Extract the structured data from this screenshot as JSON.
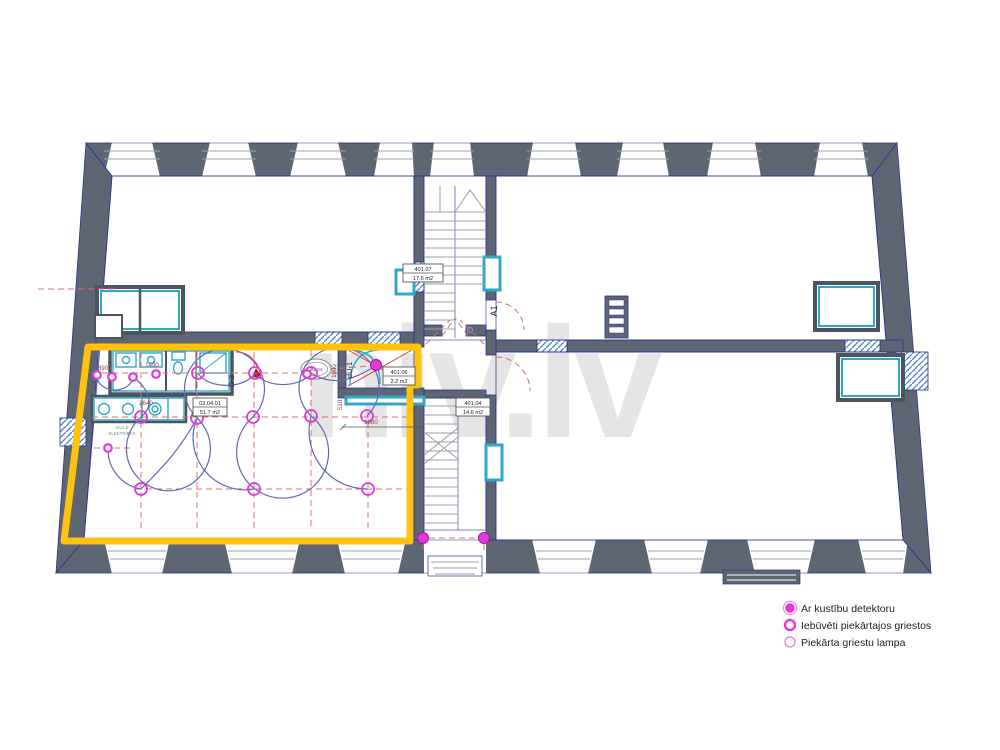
{
  "watermark": "niv.lv",
  "legend": {
    "items": [
      {
        "id": "motion-detector",
        "label": "Ar kustību detektoru"
      },
      {
        "id": "recessed-ceiling",
        "label": "Iebūvēti piekārtajos griestos"
      },
      {
        "id": "pendant-lamp",
        "label": "Piekārta griestu lampa"
      }
    ]
  },
  "rooms": {
    "main": {
      "code": "02.04.01",
      "area": "51.7 m2"
    },
    "vestibule": {
      "code": "401.06",
      "area": "2.2 m2"
    },
    "stair_top": {
      "code": "401.07",
      "area": "17.6 m2"
    },
    "stair_bottom": {
      "code": "401.04",
      "area": "14.6 m2"
    }
  },
  "annotations": {
    "axis": "A1",
    "door_d3": "D-3",
    "door_du1": "dU-1",
    "oval_mark": "Ø2.04"
  },
  "dimensions": {
    "d890": "890",
    "d1490": "1490",
    "d2640": "2640",
    "d1860": "1860",
    "d1000": "1000",
    "d510": "510"
  },
  "notes": {
    "line1": "4A/1.S",
    "line2": "ELEKTRĪBAS"
  },
  "colors": {
    "wall": "#5d6672",
    "outline": "#2e3192",
    "cyan": "#2fa7cb",
    "yellow": "#ffc20e",
    "magenta": "#e23ad8",
    "red_dash": "#d97070",
    "arc_blue": "#6366b3",
    "watermark": "#e5e5e5"
  },
  "fixtures": {
    "pendant_lamps": [
      [
        198,
        373
      ],
      [
        255,
        373
      ],
      [
        311,
        373
      ],
      [
        141,
        417
      ],
      [
        197,
        418
      ],
      [
        253,
        417
      ],
      [
        311,
        416
      ],
      [
        367,
        416
      ],
      [
        141,
        489
      ],
      [
        254,
        489
      ],
      [
        368,
        489
      ]
    ],
    "small_lamps": [
      [
        97,
        375
      ],
      [
        112,
        377
      ],
      [
        133,
        377
      ],
      [
        156,
        374
      ],
      [
        108,
        448
      ],
      [
        307,
        374
      ]
    ],
    "motion_detectors": [
      [
        376,
        365
      ],
      [
        423,
        538
      ],
      [
        484,
        538
      ]
    ]
  }
}
